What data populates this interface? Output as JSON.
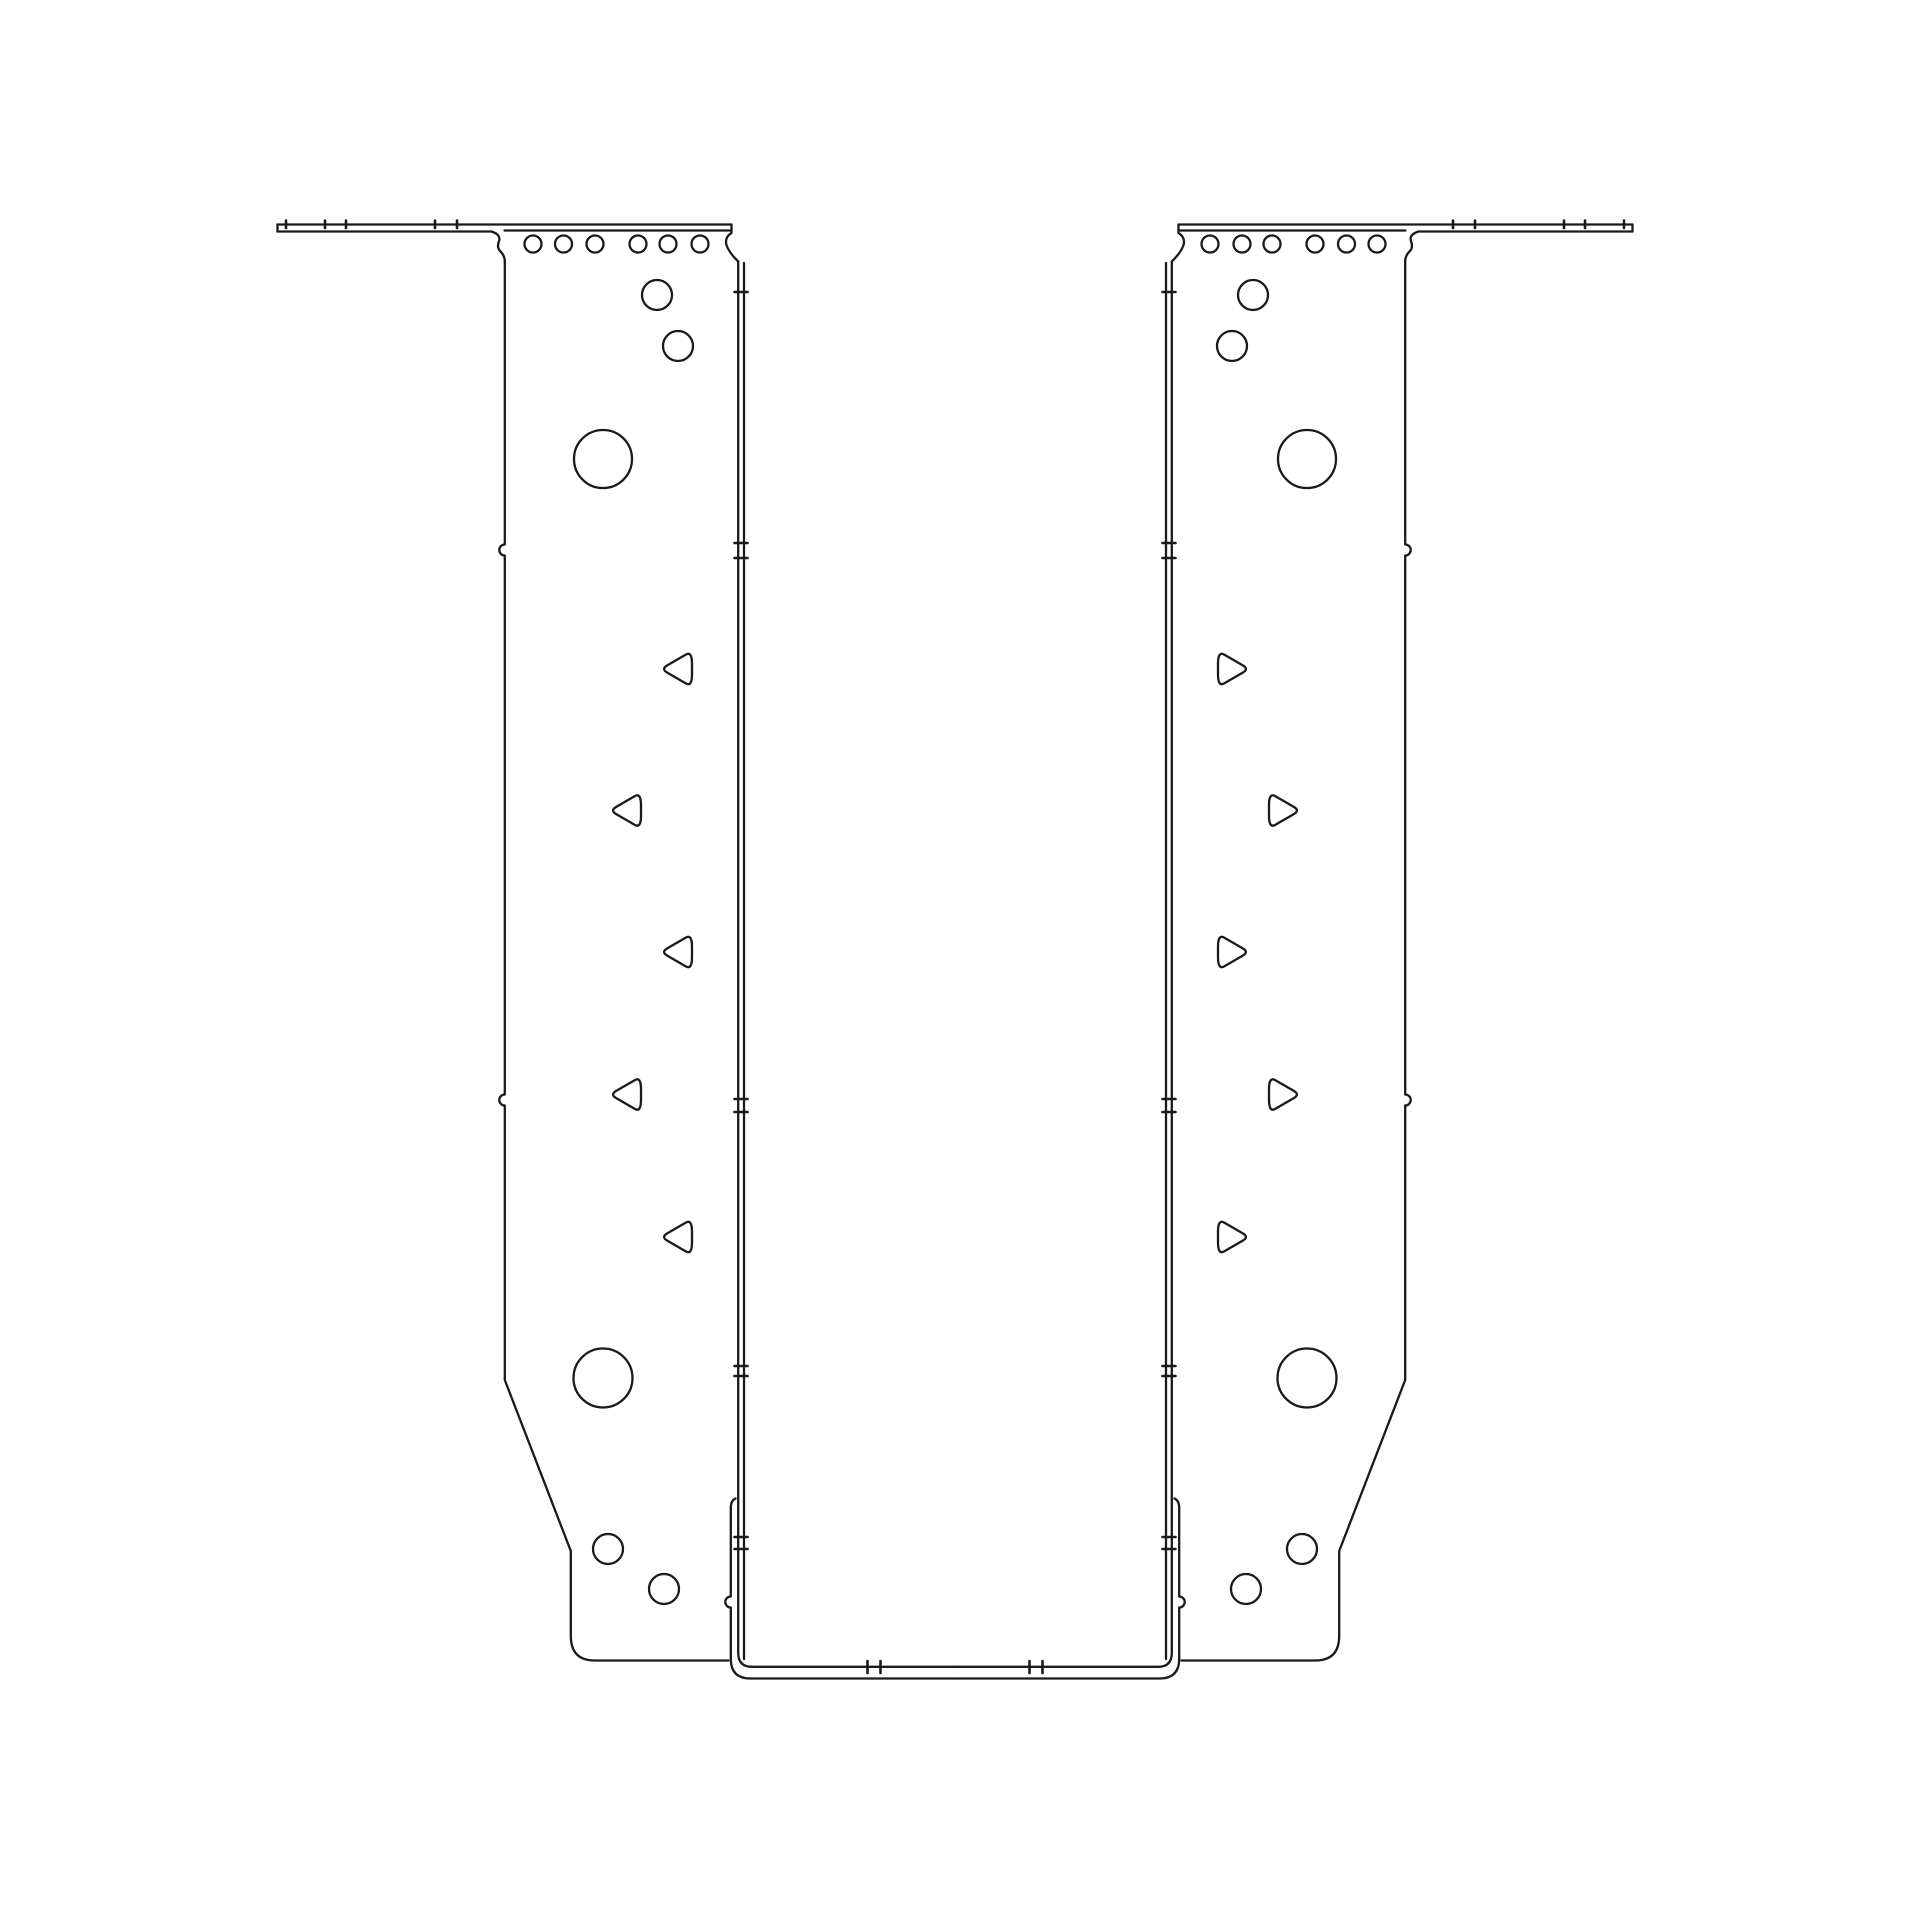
{
  "drawing": {
    "canvas": {
      "width": 1910,
      "height": 1910,
      "background": "#ffffff"
    },
    "style": {
      "stroke_color": "#1a1a1a",
      "stroke_width": 2.3,
      "tick_stroke_width": 2.6
    },
    "symmetry": {
      "mirrored": true,
      "axis_x": 955
    },
    "left_half": {
      "outline_paths": [
        {
          "name": "flange-top-edge",
          "d": "M 277.5 224.5 L 731.5 224.5"
        },
        {
          "name": "flange-underside-edge",
          "d": "M 277.5 231.5 L 491.5 231.5"
        },
        {
          "name": "flange-end-cap",
          "d": "M 277.5 224.5 L 277.5 231.5"
        },
        {
          "name": "plate-top-bend-line",
          "d": "M 504.5 230.5 L 731.5 230.5"
        },
        {
          "name": "plate-top-left-scallop",
          "d": "M 491.5 231.5 C 498 233.5 500.5 237 499 241 C 497.5 245 497.3 248.5 500.5 251.5 C 503.6 254.5 504.8 257.5 504.8 261.5"
        },
        {
          "name": "plate-outer-edge",
          "d": "M 504.8 261.5 L 504.8 544.5 A 5.5 5.5 0 0 0 504.8 555.5 L 504.8 1094.5 A 5.5 5.5 0 0 0 504.8 1105.5 L 504.8 1380 L 570.8 1551 L 570.8 1636 Q 570.8 1660.5 594.8 1660.5 L 728.5 1660.5"
        },
        {
          "name": "plate-top-right-scallop",
          "d": "M 731.5 224.5 L 731.5 233 C 726.5 236 724.8 241 726.8 246 C 728.8 251 733 256.5 738.2 261.5"
        },
        {
          "name": "stirrup-inner-line",
          "d": "M 738.2 261.5 L 738.2 1653 Q 738.2 1666.8 752 1666.8 L 955 1666.8"
        },
        {
          "name": "stirrup-bend-line",
          "d": "M 744 263 L 744 1659"
        },
        {
          "name": "seat-outer-line",
          "d": "M 735.5 1498.5 Q 730.8 1500.5 730.8 1508 L 730.8 1596.5 A 5.5 5.5 0 0 0 730.8 1607.5 L 730.8 1659 Q 730.8 1678.5 750.5 1678.5 L 955 1678.5"
        }
      ],
      "holes_round": [
        {
          "name": "top-nail-hole",
          "cx": 533,
          "cy": 244,
          "r": 8.5
        },
        {
          "name": "top-nail-hole",
          "cx": 563.5,
          "cy": 244,
          "r": 8.5
        },
        {
          "name": "top-nail-hole",
          "cx": 595,
          "cy": 244,
          "r": 8.5
        },
        {
          "name": "top-nail-hole",
          "cx": 638,
          "cy": 244,
          "r": 8.5
        },
        {
          "name": "top-nail-hole",
          "cx": 668,
          "cy": 244,
          "r": 8.5
        },
        {
          "name": "top-nail-hole",
          "cx": 700,
          "cy": 244,
          "r": 8.5
        },
        {
          "name": "face-nail-hole",
          "cx": 657,
          "cy": 295,
          "r": 15
        },
        {
          "name": "face-nail-hole",
          "cx": 678,
          "cy": 346,
          "r": 15
        },
        {
          "name": "upper-bolt-hole",
          "cx": 603,
          "cy": 459,
          "r": 29
        },
        {
          "name": "lower-bolt-hole",
          "cx": 603,
          "cy": 1378,
          "r": 29.5
        },
        {
          "name": "bottom-nail-hole",
          "cx": 608,
          "cy": 1549,
          "r": 15
        },
        {
          "name": "bottom-nail-hole",
          "cx": 664,
          "cy": 1589,
          "r": 15
        }
      ],
      "holes_triangle": [
        {
          "name": "triangle-nail-hole",
          "cx": 678,
          "cy": 669
        },
        {
          "name": "triangle-nail-hole",
          "cx": 627,
          "cy": 810.5
        },
        {
          "name": "triangle-nail-hole",
          "cx": 678,
          "cy": 952
        },
        {
          "name": "triangle-nail-hole",
          "cx": 627,
          "cy": 1094.5
        },
        {
          "name": "triangle-nail-hole",
          "cx": 678,
          "cy": 1237
        }
      ],
      "triangle_geometry": {
        "tip_dx": -17,
        "flat_dx": 14,
        "half_height": 18,
        "corner_round": 0.2
      },
      "bend_ticks": {
        "x1": 734.5,
        "x2": 747.5,
        "y_list": [
          292,
          543,
          558,
          1099,
          1112,
          1366,
          1376,
          1537,
          1549
        ]
      },
      "flange_ticks": {
        "y1": 220.5,
        "y2": 228,
        "x_list": [
          286,
          325,
          346,
          435,
          457
        ]
      },
      "seat_ticks": {
        "y1": 1661,
        "y2": 1673,
        "x_list": [
          867.5,
          880.5
        ]
      }
    }
  }
}
